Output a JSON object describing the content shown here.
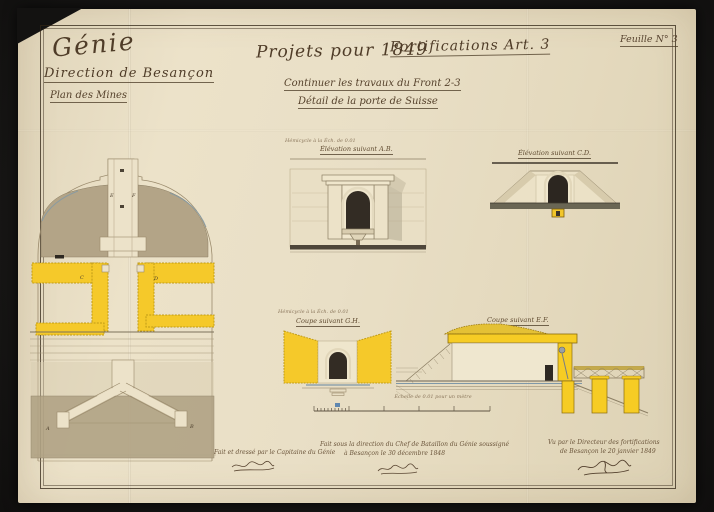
{
  "sheet": {
    "label": "Feuille N° 3"
  },
  "title_block": {
    "service": "Génie",
    "direction": "Direction de Besançon",
    "subtitle": "Plan des Mines",
    "project_line_left": "Projets pour 1849",
    "project_line_right": "Fortifications Art. 3",
    "work_line": "Continuer les travaux du Front 2-3",
    "detail_line": "Détail de la porte de Suisse"
  },
  "figures": {
    "elevation_ab": {
      "scale_note": "Hémicycle à la Éch. de 0.01",
      "caption": "Élévation suivant A.B."
    },
    "elevation_cd": {
      "caption": "Élévation suivant C.D."
    },
    "coupe_gh": {
      "scale_note": "Hémicycle à la Éch. de 0.01",
      "caption": "Coupe suivant G.H."
    },
    "coupe_ef": {
      "caption": "Coupe suivant E.F."
    },
    "plan_marks": [
      "A",
      "B",
      "C",
      "D",
      "E",
      "F"
    ]
  },
  "scale_bar": {
    "caption": "Échelle de 0.01 pour un mètre"
  },
  "signatures": {
    "drafted": {
      "line1": "Fait et dressé par le Capitaine du Génie"
    },
    "supervised": {
      "line1": "Fait sous la direction du Chef de Bataillon du Génie soussigné",
      "line2": "à Besançon le 30 décembre 1848"
    },
    "approved": {
      "line1": "Vu par le Directeur des fortifications",
      "line2": "de Besançon le 20 janvier 1849"
    }
  },
  "colors": {
    "backdrop": "#171614",
    "paper": "#e9dfc6",
    "ink": "#5a4632",
    "pencil": "#9b8b6d",
    "masonry_yellow": "#f5c92a",
    "earth_tan": "#b3a487",
    "opening_dark": "#2e2923",
    "water_blue": "#7f98a8",
    "ground_dark": "#6a6654"
  }
}
